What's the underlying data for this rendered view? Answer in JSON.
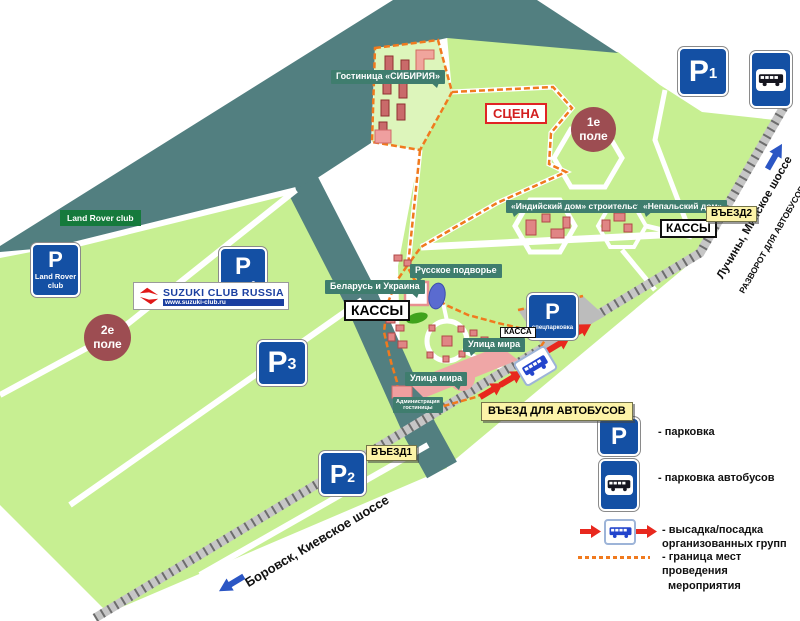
{
  "labels": {
    "hotel_sibiria": "Гостиница «СИБИРИЯ»",
    "stage": "СЦЕНА",
    "field1": {
      "line1": "1е",
      "line2": "поле"
    },
    "field2": {
      "line1": "2е",
      "line2": "поле"
    },
    "indian_house": "«Индийский дом» строительство",
    "nepali_house": "«Непальский дом»",
    "russian_courtyard": "Русское подворье",
    "belarus_ukraine": "Беларусь и Украина",
    "peace_street_1": "Улица мира",
    "peace_street_2": "Улица мира",
    "hotel_admin": {
      "line1": "Администрация",
      "line2": "гостиницы"
    },
    "land_rover_area": "Land Rover club"
  },
  "tickets": {
    "main": "КАССЫ",
    "east": "КАССЫ",
    "small": "КАССА"
  },
  "entrances": {
    "e1": "ВЪЕЗД1",
    "e2": "ВЪЕЗД2",
    "bus": "ВЪЕЗД ДЛЯ АВТОБУСОВ"
  },
  "parking": {
    "p1": {
      "letter": "P",
      "sub": "1"
    },
    "p2": {
      "letter": "P",
      "sub": "2"
    },
    "p3": {
      "letter": "P",
      "sub": "3"
    },
    "land_rover": {
      "letter": "P",
      "cap1": "Land Rover",
      "cap2": "club"
    },
    "autoclubs": {
      "letter": "P",
      "cap": "автоклубы"
    },
    "special": {
      "letter": "P",
      "cap": "спецпарковка"
    },
    "legend": {
      "letter": "P"
    }
  },
  "roads": {
    "kiev": "Боровск, Киевское шоссе",
    "minsk": "Лучины, Минское шоссе",
    "turnaround": "РАЗВОРОТ ДЛЯ АВТОБУСОВ"
  },
  "banner": {
    "title": "SUZUKI CLUB RUSSIA",
    "url": "www.suzuki-club.ru"
  },
  "legend": {
    "parking": "- парковка",
    "bus_parking": "- парковка автобусов",
    "dropoff1": "- высадка/посадка",
    "dropoff2": "организованных групп",
    "boundary1": "- граница мест проведения",
    "boundary2": "мероприятия"
  },
  "colors": {
    "field_green": "#c7ef92",
    "forest_teal": "#527f80",
    "sign_blue": "#1450a4",
    "boundary_orange": "#f07a1e",
    "arrow_red": "#e8281e",
    "arrow_blue": "#2b56c4",
    "field_circle_brown": "#9d4d52"
  }
}
